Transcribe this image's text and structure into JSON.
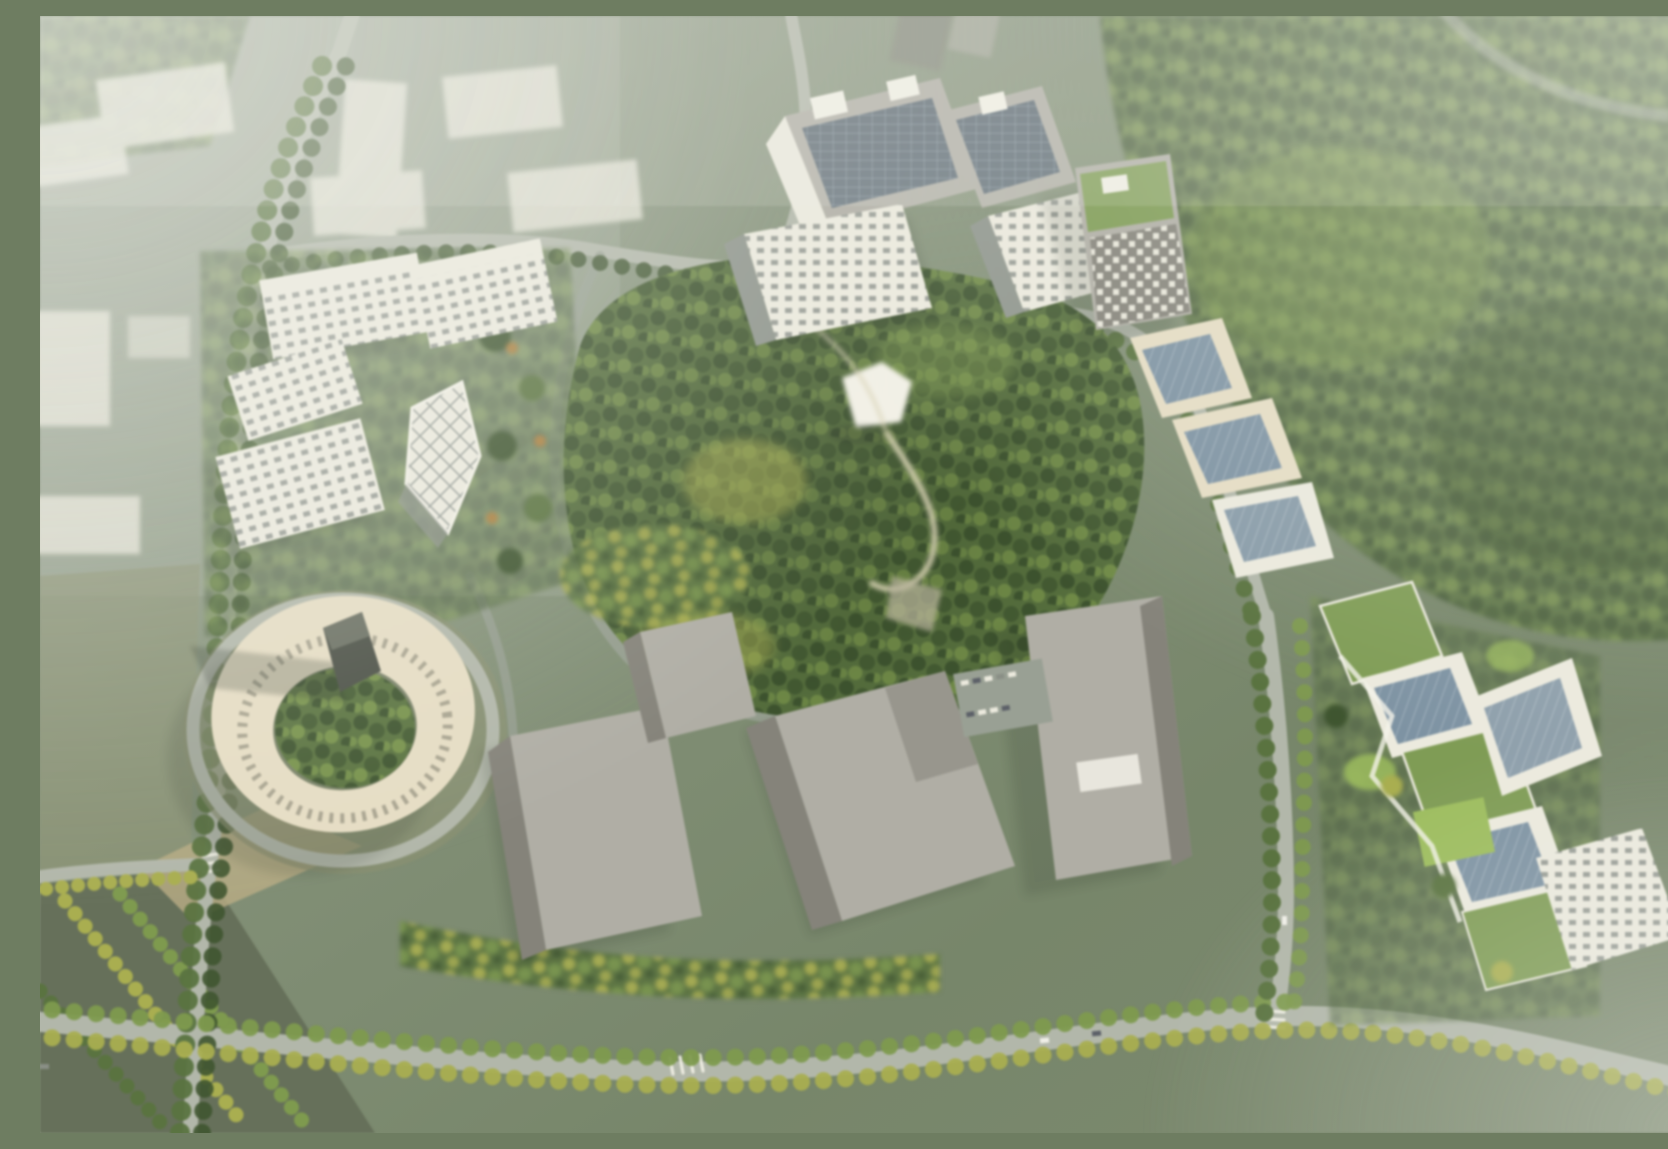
{
  "scene": {
    "type": "aerial-architectural-rendering",
    "description": "Hazy bird's-eye rendering of a campus masterplan: a dense hilltop tree park at the center ringed by roads; white terraced office blocks with gridded facades to the west; solar-panel-roofed blocks and a stepped tower group to the north and northeast; a cream circular courtyard building with a dark sculptural tower and long shadow to the southwest; large gray exhibition halls and a parking lot to the south; terraced green-roofed buildings with gardens to the east; misty city blocks to the northwest and foggy forest to the northeast."
  },
  "palette": {
    "mist": "#c2cabf",
    "hazeWhite": "#e9ece3",
    "groundBase": "#7a8a68",
    "groundOlive": "#8a9171",
    "forestDark": "#3f5530",
    "forestMid": "#5a7340",
    "forestLight": "#7e9a4e",
    "treeYellow": "#a9ae50",
    "treeOrange": "#a97f3f",
    "parkPath": "#d8d2b4",
    "road": "#b2b7aa",
    "roadDark": "#99a094",
    "buildingWhite": "#eceade",
    "buildingCream": "#e6ddc4",
    "facadeShadow": "#8f958d",
    "solarPanel": "#5d6a74",
    "glassBlue": "#7e93a3",
    "grayRoof": "#b0aea5",
    "graySide": "#85837a",
    "darkTower": "#4a4f45",
    "greenRoof": "#7f9c55",
    "lawnBright": "#9dbd5e",
    "skylight": "#f2f0e6",
    "shadow": "rgba(38,46,36,0.45)"
  },
  "regions": {
    "background": {
      "label": "Hazy aerial backdrop"
    },
    "northwest_district": {
      "label": "Misty city blocks beyond the northwest road"
    },
    "northeast_forest": {
      "label": "Fog-covered forest and meadow to the northeast"
    },
    "southwest_fields": {
      "label": "Tree-row fields and road junction to the southwest"
    },
    "road_network": {
      "label": "Tree-lined campus loop roads"
    },
    "central_park": {
      "label": "Central hilltop tree park with white pavilion and winding paths"
    },
    "north_cluster": {
      "label": "Solar-roofed office blocks on the north edge"
    },
    "northeast_cluster": {
      "label": "Checkered tower with stepped blocks descending southeast"
    },
    "west_cluster": {
      "label": "White terraced offices with gridded facades and lattice tower"
    },
    "circular_building": {
      "label": "Cream ring building around a tree courtyard with dark sculpture tower"
    },
    "south_cluster": {
      "label": "Large gray halls with parking lot to the south"
    },
    "east_cluster": {
      "label": "Terraced green-roof buildings with courtyard gardens to the east"
    },
    "haze": {
      "label": "Atmospheric white haze over the corners"
    }
  }
}
